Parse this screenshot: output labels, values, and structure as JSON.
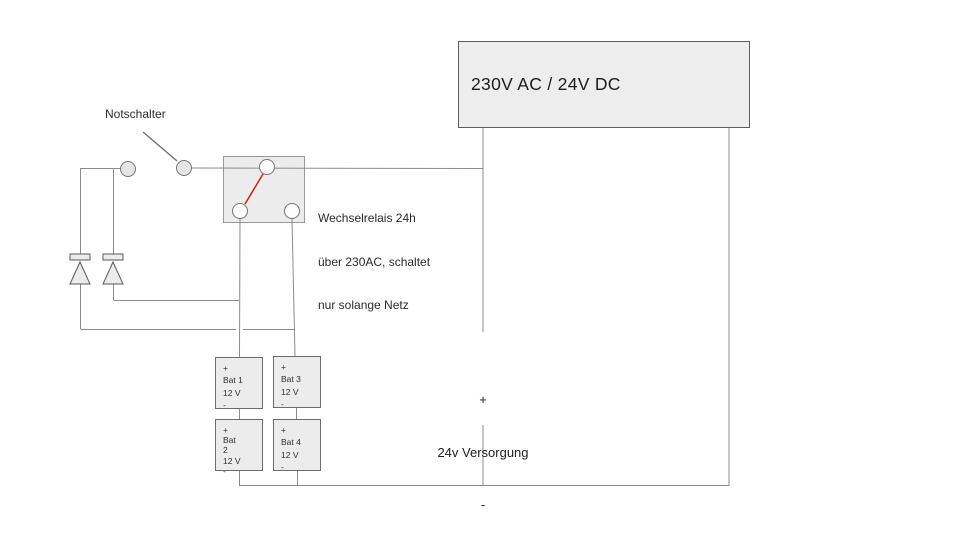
{
  "diagram": {
    "power_supply": {
      "label": "230V AC / 24V DC"
    },
    "emergency_switch": {
      "label": "Notschalter"
    },
    "relay_note": {
      "line1": "Wechselrelais 24h",
      "line2": "über 230AC, schaltet",
      "line3": "nur solange Netz"
    },
    "supply_24v": {
      "plus": "+",
      "label": "24v Versorgung",
      "minus": "-"
    },
    "batteries": [
      {
        "name": "Bat 1",
        "lines": [
          "+",
          "Bat 1",
          "12 V",
          "-"
        ]
      },
      {
        "name": "Bat 2",
        "lines": [
          "+",
          "Bat",
          "2",
          "12 V",
          "-"
        ]
      },
      {
        "name": "Bat 3",
        "lines": [
          "+",
          "Bat 3",
          "12 V",
          "-"
        ]
      },
      {
        "name": "Bat 4",
        "lines": [
          "+",
          "Bat 4",
          "12 V",
          "-"
        ]
      }
    ],
    "colors": {
      "relay_active_link": "#cc2a1f",
      "wire": "#8c8c8c",
      "box_fill": "#ededed"
    }
  }
}
